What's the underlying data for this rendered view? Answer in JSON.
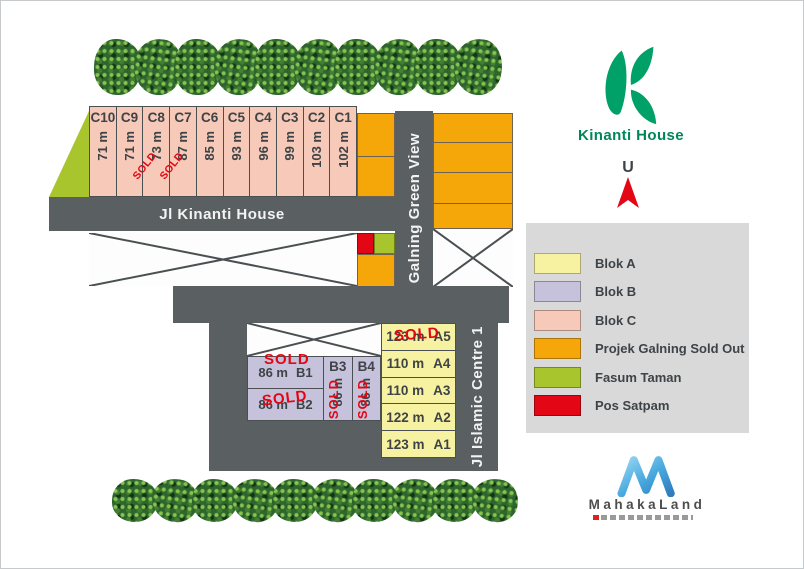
{
  "sold_label": "SOLD",
  "roads": {
    "kinanti": "Jl Kinanti House",
    "galning": "Jl Galning Green View",
    "islamic": "Jl Islamic Centre 1"
  },
  "logo": {
    "name": "Kinanti House"
  },
  "north": {
    "label": "U"
  },
  "brand": {
    "name": "MahakaLand"
  },
  "legend": {
    "items": [
      {
        "label": "Blok A",
        "color": "#f7f2a2"
      },
      {
        "label": "Blok B",
        "color": "#c6c2db"
      },
      {
        "label": "Blok C",
        "color": "#f6c9b8"
      },
      {
        "label": "Projek Galning Sold Out",
        "color": "#f5a70a"
      },
      {
        "label": "Fasum Taman",
        "color": "#a8c52e"
      },
      {
        "label": "Pos Satpam",
        "color": "#e30615"
      }
    ]
  },
  "plan": {
    "c_row": [
      {
        "id": "C10",
        "size": "71 m",
        "sold": false
      },
      {
        "id": "C9",
        "size": "71 m",
        "sold": false
      },
      {
        "id": "C8",
        "size": "73 m",
        "sold": true
      },
      {
        "id": "C7",
        "size": "87 m",
        "sold": true
      },
      {
        "id": "C6",
        "size": "85 m",
        "sold": false
      },
      {
        "id": "C5",
        "size": "93 m",
        "sold": false
      },
      {
        "id": "C4",
        "size": "96 m",
        "sold": false
      },
      {
        "id": "C3",
        "size": "99 m",
        "sold": false
      },
      {
        "id": "C2",
        "size": "103 m",
        "sold": false
      },
      {
        "id": "C1",
        "size": "102 m",
        "sold": false
      }
    ],
    "b_lots": [
      {
        "id": "B1",
        "size": "86 m",
        "sold": true
      },
      {
        "id": "B2",
        "size": "86 m",
        "sold": true
      },
      {
        "id": "B3",
        "size": "86 m",
        "sold": true
      },
      {
        "id": "B4",
        "size": "86 m",
        "sold": true
      }
    ],
    "a_lots": [
      {
        "id": "A5",
        "size": "123 m",
        "sold": true
      },
      {
        "id": "A4",
        "size": "110 m",
        "sold": false
      },
      {
        "id": "A3",
        "size": "110 m",
        "sold": false
      },
      {
        "id": "A2",
        "size": "122 m",
        "sold": false
      },
      {
        "id": "A1",
        "size": "123 m",
        "sold": false
      }
    ]
  },
  "colors": {
    "road": "#5a5f61",
    "blok_a": "#f7f2a2",
    "blok_b": "#c6c2db",
    "blok_c": "#f6c9b8",
    "orange": "#f5a70a",
    "green": "#a8c52e",
    "red": "#e30615",
    "sold": "#e30613",
    "legend_bg": "#d9d9d9",
    "kinanti_green": "#00a168"
  }
}
